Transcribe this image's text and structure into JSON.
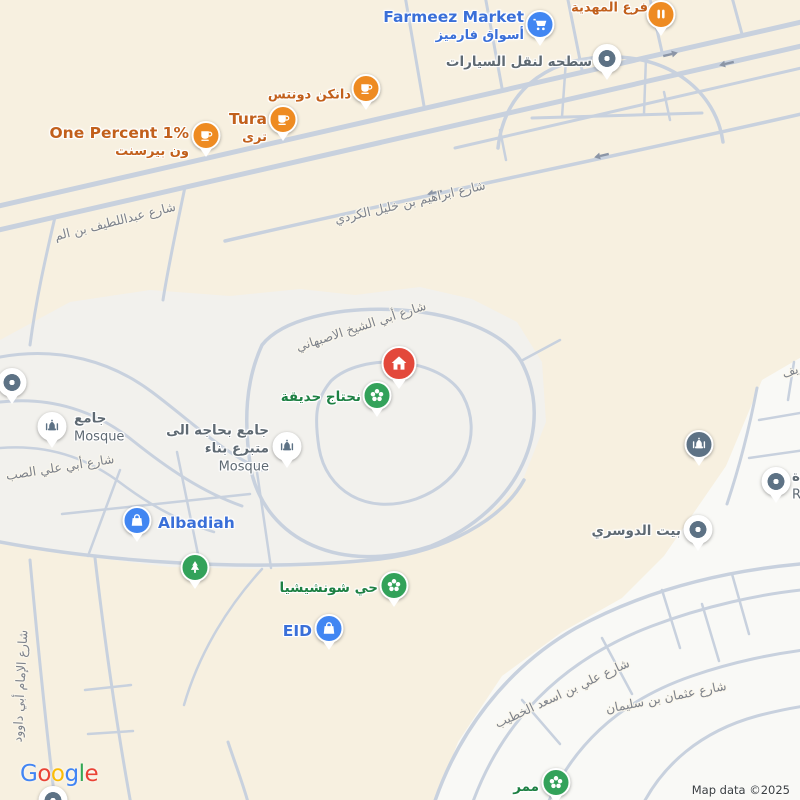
{
  "attribution": {
    "google": "Google",
    "map_data": "Map data ©2025"
  },
  "colors": {
    "background": "#f7f0e0",
    "subdivision_mid": "#f2f1ed",
    "subdivision_br": "#f9f9f6",
    "road": "#c8d1de",
    "arrow": "#8b95a6",
    "pin_orange": "#ee8b22",
    "pin_blue": "#4186f2",
    "pin_green": "#33a25a",
    "pin_red": "#e3483b",
    "pin_slate": "#5d7285",
    "label_orange": "#c2601c",
    "label_blue": "#3a6fd8",
    "label_green": "#1d8043",
    "label_gray": "#5f6a73",
    "street_gray": "#7d828b",
    "google_letters": [
      "#4285F4",
      "#EA4335",
      "#FBBC05",
      "#4285F4",
      "#34A853",
      "#EA4335"
    ]
  },
  "streets": [
    {
      "name": "شارع عبداللطيف بن الم",
      "x": 115,
      "y": 221,
      "rotate": -14
    },
    {
      "name": "شارع ابراهيم بن خليل الكردي",
      "x": 410,
      "y": 202,
      "rotate": -13
    },
    {
      "name": "شارع أبي الشيخ الاصبهاني",
      "x": 361,
      "y": 326,
      "rotate": -18
    },
    {
      "name": "شارع أبي علي الصب",
      "x": 60,
      "y": 467,
      "rotate": -9
    },
    {
      "name": "شارع الإمام أبي داوود",
      "x": 20,
      "y": 686,
      "rotate": -87
    },
    {
      "name": "شارع علي بن اسعد الخطيب",
      "x": 562,
      "y": 693,
      "rotate": -25
    },
    {
      "name": "شارع عثمان بن سليمان",
      "x": 666,
      "y": 697,
      "rotate": -11
    },
    {
      "name": "يف",
      "x": 790,
      "y": 371,
      "rotate": -20
    }
  ],
  "pois": [
    {
      "name": "mahdia-branch",
      "pin": "orange",
      "icon": "store-icon",
      "x": 661,
      "y": 36,
      "side": "left",
      "lx": 648,
      "ly": 8,
      "lines": [
        {
          "text": "فرع المهدية",
          "style": "ar-orange"
        }
      ]
    },
    {
      "name": "farmeez-market",
      "pin": "blue",
      "icon": "shopping-cart-icon",
      "x": 540,
      "y": 46,
      "side": "left",
      "lx": 524,
      "ly": 26,
      "lines": [
        {
          "text": "Farmeez Market",
          "style": "en-blue"
        },
        {
          "text": "أسواق فارميز",
          "style": "ar-blue"
        }
      ]
    },
    {
      "name": "car-towing",
      "pin": "dot",
      "icon": "dot-icon",
      "x": 607,
      "y": 80,
      "side": "left",
      "lx": 592,
      "ly": 63,
      "lines": [
        {
          "text": "سطحه لنقل السيارات",
          "style": "ar-gray"
        }
      ]
    },
    {
      "name": "dunkin-donuts",
      "pin": "orange",
      "icon": "coffee-cup-icon",
      "x": 366,
      "y": 110,
      "side": "left",
      "lx": 351,
      "ly": 95,
      "lines": [
        {
          "text": "دانكن دونتس",
          "style": "ar-orange"
        }
      ]
    },
    {
      "name": "tura-cafe",
      "pin": "orange",
      "icon": "coffee-cup-icon",
      "x": 283,
      "y": 141,
      "side": "left",
      "lx": 267,
      "ly": 128,
      "lines": [
        {
          "text": "Tura",
          "style": "en-orange"
        },
        {
          "text": "ترى",
          "style": "ar-orange"
        }
      ]
    },
    {
      "name": "one-percent-cafe",
      "pin": "orange",
      "icon": "coffee-cup-icon",
      "x": 206,
      "y": 157,
      "side": "left",
      "lx": 189,
      "ly": 142,
      "lines": [
        {
          "text": "One Percent 1%",
          "style": "en-orange"
        },
        {
          "text": "ون بيرسنت",
          "style": "ar-orange"
        }
      ]
    },
    {
      "name": "home-marker",
      "pin": "red",
      "icon": "house-icon",
      "x": 399,
      "y": 389
    },
    {
      "name": "need-garden",
      "pin": "green",
      "icon": "flower-icon",
      "x": 377,
      "y": 417,
      "side": "left",
      "lx": 361,
      "ly": 398,
      "lines": [
        {
          "text": "نحتاج حديقة",
          "style": "ar-green"
        }
      ]
    },
    {
      "name": "mosque-west",
      "pin": "mosque-light",
      "icon": "mosque-icon",
      "x": 52,
      "y": 448,
      "side": "right",
      "lx": 74,
      "ly": 428,
      "lines": [
        {
          "text": "جامع",
          "style": "ar-gray"
        },
        {
          "text": "Mosque",
          "style": "en-gray"
        }
      ]
    },
    {
      "name": "mosque-needs-donor",
      "pin": "mosque-light",
      "icon": "mosque-icon",
      "x": 287,
      "y": 468,
      "side": "left",
      "lx": 269,
      "ly": 449,
      "lines": [
        {
          "text": "جامع بحاجه الى",
          "style": "ar-gray"
        },
        {
          "text": "متبرع بناء",
          "style": "ar-gray"
        },
        {
          "text": "Mosque",
          "style": "en-gray"
        }
      ]
    },
    {
      "name": "poi-dot-west",
      "pin": "dot",
      "icon": "dot-icon",
      "x": 12,
      "y": 404
    },
    {
      "name": "albadiah",
      "pin": "blue",
      "icon": "shopping-bag-icon",
      "x": 137,
      "y": 542,
      "side": "right",
      "lx": 158,
      "ly": 523,
      "lines": [
        {
          "text": "Albadiah",
          "style": "en-blue"
        }
      ]
    },
    {
      "name": "park-tree",
      "pin": "green",
      "icon": "tree-icon",
      "x": 195,
      "y": 589
    },
    {
      "name": "shunshisha-district",
      "pin": "green",
      "icon": "flower-icon",
      "x": 394,
      "y": 607,
      "side": "left",
      "lx": 378,
      "ly": 589,
      "lines": [
        {
          "text": "حي شونشيشيا",
          "style": "ar-green"
        }
      ]
    },
    {
      "name": "eid-store",
      "pin": "blue",
      "icon": "shopping-bag-icon",
      "x": 329,
      "y": 650,
      "side": "left",
      "lx": 312,
      "ly": 631,
      "lines": [
        {
          "text": "EID",
          "style": "en-blue"
        }
      ]
    },
    {
      "name": "mosque-east",
      "pin": "mosque-dark",
      "icon": "mosque-icon",
      "x": 699,
      "y": 466
    },
    {
      "name": "poi-dot-east",
      "pin": "dot",
      "icon": "dot-icon",
      "x": 776,
      "y": 503,
      "side": "right",
      "lx": 792,
      "ly": 486,
      "lines": [
        {
          "text": "ة",
          "style": "ar-gray"
        },
        {
          "text": "R",
          "style": "en-gray"
        }
      ]
    },
    {
      "name": "dosari-house",
      "pin": "dot",
      "icon": "dot-icon",
      "x": 698,
      "y": 551,
      "side": "left",
      "lx": 681,
      "ly": 532,
      "lines": [
        {
          "text": "بيت الدوسري",
          "style": "ar-gray"
        }
      ]
    },
    {
      "name": "mamar-walkway",
      "pin": "green",
      "icon": "flower-icon",
      "x": 556,
      "y": 804,
      "side": "left",
      "lx": 539,
      "ly": 788,
      "lines": [
        {
          "text": "ممر",
          "style": "ar-green"
        }
      ]
    },
    {
      "name": "poi-dot-southwest",
      "pin": "dot",
      "icon": "dot-icon",
      "x": 53,
      "y": 822
    }
  ]
}
